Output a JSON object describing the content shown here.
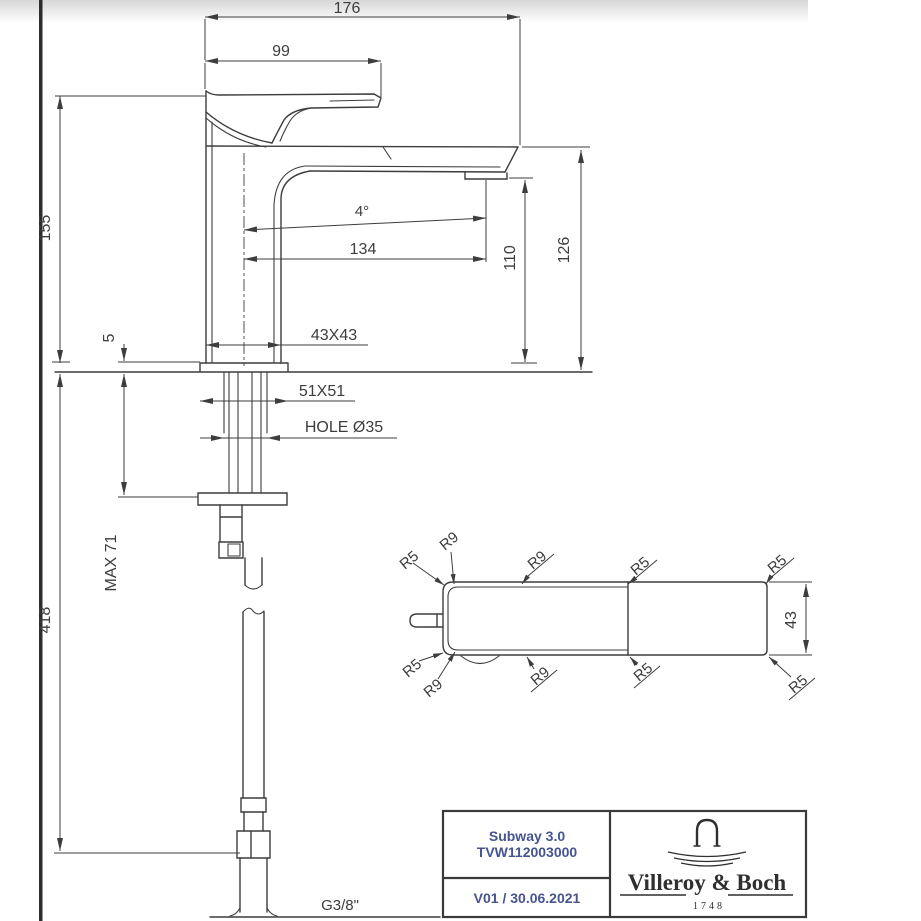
{
  "side": {
    "d176": "176",
    "d99": "99",
    "d155": "155",
    "d5": "5",
    "d418": "418",
    "dmax71": "MAX 71",
    "d43x43": "43X43",
    "d51x51": "51X51",
    "dhole": "HOLE Ø35",
    "dangle": "4°",
    "d134": "134",
    "d110": "110",
    "d126": "126",
    "dthread": "G3/8\""
  },
  "top_view": {
    "callouts": {
      "top_left_r5": "R5",
      "top_left_r9": "R9",
      "top_mid_r9": "R9",
      "top_mid_r5": "R5",
      "top_right_r5": "R5",
      "bottom_left_r5": "R5",
      "bottom_left_r9": "R9",
      "bottom_mid_r9": "R9",
      "bottom_mid_r5": "R5",
      "bottom_right_r5": "R5"
    },
    "d43": "43"
  },
  "title_block": {
    "product_name": "Subway 3.0",
    "product_code": "TVW112003000",
    "revision": "V01 / 30.06.2021",
    "brand": "Villeroy & Boch",
    "brand_year": "1748"
  },
  "colors": {
    "line": "#3d3d3d",
    "accent_text": "#46548f",
    "brand_text": "#2f2f2f"
  }
}
